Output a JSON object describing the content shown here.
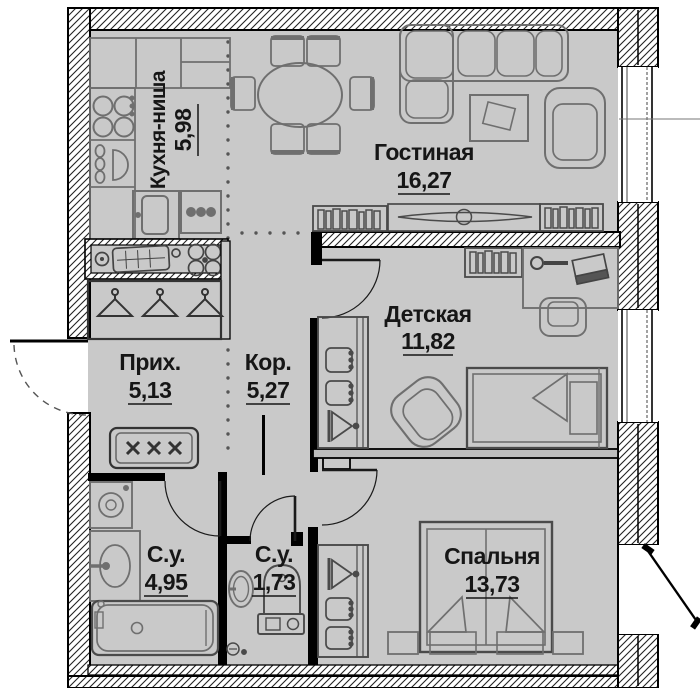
{
  "plan_title": "apartment-floor-plan",
  "colors": {
    "floor": "#c9c9c9",
    "wall_fill": "#ffffff",
    "wall_line": "#000000",
    "furniture_line": "#6f6f6f",
    "text": "#161616"
  },
  "rooms": [
    {
      "id": "kitchen",
      "name": "Кухня-ниша",
      "area": "5,98"
    },
    {
      "id": "living",
      "name": "Гостиная",
      "area": "16,27"
    },
    {
      "id": "children",
      "name": "Детская",
      "area": "11,82"
    },
    {
      "id": "hallway",
      "name": "Прих.",
      "area": "5,13"
    },
    {
      "id": "corridor",
      "name": "Кор.",
      "area": "5,27"
    },
    {
      "id": "bathroom",
      "name": "С.у.",
      "area": "4,95"
    },
    {
      "id": "wc",
      "name": "С.у.",
      "area": "1,73"
    },
    {
      "id": "bedroom",
      "name": "Спальня",
      "area": "13,73"
    }
  ]
}
